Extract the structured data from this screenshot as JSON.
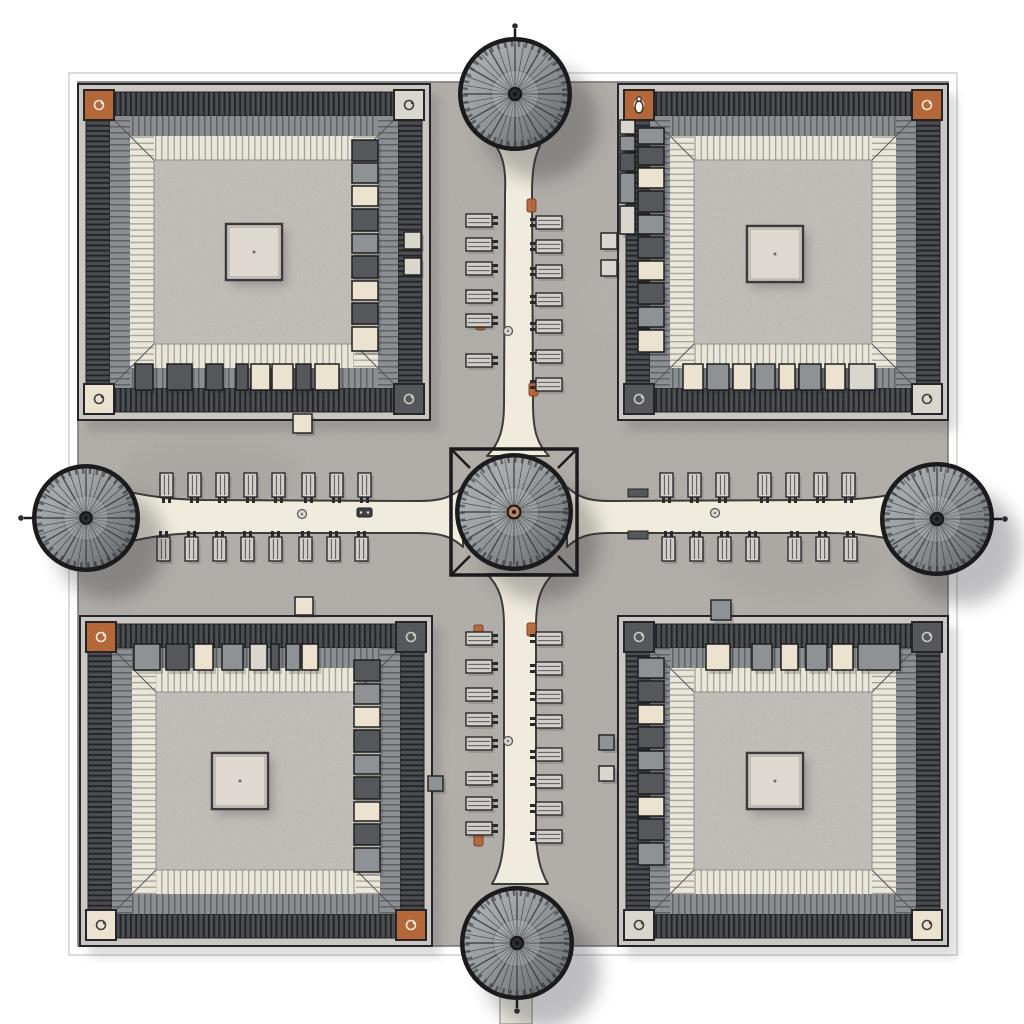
{
  "scene": {
    "type": "architectural-site-plan",
    "view": "top-down plan, hand-drawn ink and wash",
    "elements": "four courtyard buildings, five circular pavilion roofs, cross pathways with benches, market stalls, copper corner pavilions"
  },
  "colors": {
    "page_bg": "#ffffff",
    "ground": "#b5b2ad",
    "courtyard": "#c8c5bf",
    "wall_light": "#cac7c2",
    "outline": "#26262a",
    "path_cream": "#efebdd",
    "corner_copper": "#b4683a",
    "corner_cream": "#ede5cf",
    "corner_light": "#d6d3cb",
    "corner_dark": "#5a5c5f",
    "stall_dark": "#55575a",
    "stall_mid": "#8f9294",
    "stall_cream": "#ebe3cf",
    "stall_light": "#d9d6ce",
    "hub_copper": "#b9824f",
    "accent_orange": "#b5673a",
    "rim_dark": "#1b1b1d"
  },
  "ground": {
    "x": 78,
    "y": 82,
    "w": 870,
    "h": 864
  },
  "boundary": {
    "inner": [
      78,
      82,
      870,
      864
    ],
    "outer": [
      69,
      73,
      888,
      882
    ]
  },
  "buildings": [
    {
      "id": "northwest",
      "x": 78,
      "y": 84,
      "w": 352,
      "h": 336,
      "corners": {
        "tl": "copper",
        "tr": "light",
        "bl": "cream",
        "br": "dark"
      },
      "platform_dx": 0,
      "platform_dy": 0,
      "stall_rows": [
        {
          "dir": "h",
          "edge": "s",
          "boxes": [
            [
              135,
              18,
              "dark"
            ],
            [
              167,
              25,
              "dark"
            ],
            [
              206,
              17,
              "dark"
            ],
            [
              236,
              12,
              "dark"
            ],
            [
              251,
              19,
              "cream"
            ],
            [
              272,
              21,
              "cream"
            ],
            [
              296,
              15,
              "dark"
            ],
            [
              315,
              24,
              "cream"
            ]
          ]
        },
        {
          "dir": "v",
          "edge": "e",
          "boxes": [
            [
              140,
              21,
              "dark"
            ],
            [
              163,
              20,
              "mid"
            ],
            [
              186,
              20,
              "cream"
            ],
            [
              209,
              22,
              "dark"
            ],
            [
              234,
              19,
              "mid"
            ],
            [
              256,
              22,
              "dark"
            ],
            [
              281,
              19,
              "cream"
            ],
            [
              303,
              21,
              "dark"
            ],
            [
              327,
              24,
              "cream"
            ]
          ]
        }
      ],
      "kiosks": [
        [
          404,
          232,
          17,
          "light"
        ],
        [
          404,
          258,
          17,
          "light"
        ],
        [
          293,
          414,
          19,
          "cream"
        ]
      ]
    },
    {
      "id": "northeast",
      "x": 618,
      "y": 84,
      "w": 330,
      "h": 336,
      "corners": {
        "tl": "copper",
        "tr": "copper",
        "bl": "dark",
        "br": "light"
      },
      "corner_figure": "tl",
      "platform_dx": -8,
      "platform_dy": 2,
      "stall_rows": [
        {
          "dir": "v",
          "edge": "w",
          "boxes": [
            [
              128,
              16,
              "mid"
            ],
            [
              147,
              18,
              "dark"
            ],
            [
              168,
              20,
              "cream"
            ],
            [
              191,
              21,
              "dark"
            ],
            [
              215,
              19,
              "mid"
            ],
            [
              237,
              21,
              "dark"
            ],
            [
              261,
              19,
              "cream"
            ],
            [
              283,
              21,
              "dark"
            ],
            [
              307,
              20,
              "mid"
            ],
            [
              330,
              22,
              "cream"
            ]
          ]
        },
        {
          "dir": "v",
          "edge": "w",
          "x_override": 620,
          "w": 15,
          "boxes": [
            [
              120,
              14,
              "light"
            ],
            [
              136,
              15,
              "mid"
            ],
            [
              153,
              18,
              "dark"
            ],
            [
              173,
              30,
              "mid"
            ],
            [
              206,
              28,
              "light"
            ]
          ]
        },
        {
          "dir": "h",
          "edge": "s",
          "boxes": [
            [
              683,
              20,
              "cream"
            ],
            [
              707,
              22,
              "mid"
            ],
            [
              733,
              18,
              "cream"
            ],
            [
              755,
              20,
              "mid"
            ],
            [
              779,
              16,
              "cream"
            ],
            [
              799,
              22,
              "mid"
            ],
            [
              825,
              20,
              "cream"
            ],
            [
              849,
              26,
              "light"
            ]
          ]
        }
      ],
      "kiosks": [
        [
          601,
          233,
          16,
          "light"
        ],
        [
          601,
          260,
          16,
          "light"
        ]
      ]
    },
    {
      "id": "southwest",
      "x": 80,
      "y": 616,
      "w": 352,
      "h": 330,
      "corners": {
        "tl": "copper",
        "tr": "dark",
        "bl": "cream",
        "br": "copper"
      },
      "platform_dx": -16,
      "platform_dy": 0,
      "stall_rows": [
        {
          "dir": "h",
          "edge": "n",
          "boxes": [
            [
              134,
              26,
              "mid"
            ],
            [
              166,
              23,
              "dark"
            ],
            [
              194,
              19,
              "cream"
            ],
            [
              222,
              21,
              "mid"
            ],
            [
              250,
              17,
              "light"
            ],
            [
              271,
              8,
              "dark"
            ],
            [
              286,
              14,
              "mid"
            ],
            [
              302,
              16,
              "cream"
            ]
          ]
        },
        {
          "dir": "v",
          "edge": "e",
          "boxes": [
            [
              660,
              21,
              "dark"
            ],
            [
              684,
              20,
              "mid"
            ],
            [
              707,
              20,
              "cream"
            ],
            [
              730,
              22,
              "dark"
            ],
            [
              755,
              19,
              "mid"
            ],
            [
              777,
              22,
              "dark"
            ],
            [
              802,
              19,
              "cream"
            ],
            [
              824,
              21,
              "dark"
            ],
            [
              848,
              24,
              "mid"
            ]
          ]
        }
      ],
      "kiosks": [
        [
          295,
          597,
          18,
          "cream"
        ],
        [
          428,
          776,
          15,
          "mid"
        ]
      ]
    },
    {
      "id": "southeast",
      "x": 618,
      "y": 616,
      "w": 330,
      "h": 330,
      "corners": {
        "tl": "dark",
        "tr": "dark",
        "bl": "light",
        "br": "cream"
      },
      "platform_dx": -8,
      "platform_dy": 0,
      "stall_rows": [
        {
          "dir": "h",
          "edge": "n",
          "boxes": [
            [
              706,
              24,
              "cream"
            ],
            [
              752,
              20,
              "mid"
            ],
            [
              781,
              17,
              "cream"
            ],
            [
              806,
              21,
              "mid"
            ],
            [
              832,
              21,
              "cream"
            ],
            [
              858,
              42,
              "mid"
            ]
          ]
        },
        {
          "dir": "v",
          "edge": "w",
          "boxes": [
            [
              658,
              20,
              "mid"
            ],
            [
              681,
              21,
              "dark"
            ],
            [
              705,
              19,
              "cream"
            ],
            [
              727,
              21,
              "dark"
            ],
            [
              751,
              19,
              "mid"
            ],
            [
              773,
              21,
              "dark"
            ],
            [
              797,
              19,
              "cream"
            ],
            [
              819,
              21,
              "dark"
            ],
            [
              843,
              22,
              "mid"
            ]
          ]
        }
      ],
      "kiosks": [
        [
          711,
          600,
          20,
          "mid"
        ],
        [
          599,
          735,
          15,
          "mid"
        ],
        [
          599,
          766,
          15,
          "light"
        ]
      ]
    }
  ],
  "pavilions": [
    {
      "id": "north",
      "cx": 515,
      "cy": 94,
      "r": 56,
      "finial": "n"
    },
    {
      "id": "south",
      "cx": 517,
      "cy": 943,
      "r": 56,
      "finial": "s"
    },
    {
      "id": "west",
      "cx": 86,
      "cy": 518,
      "r": 53,
      "finial": "w"
    },
    {
      "id": "east",
      "cx": 937,
      "cy": 519,
      "r": 56,
      "finial": "e"
    },
    {
      "id": "center",
      "cx": 514,
      "cy": 512,
      "r": 58,
      "finial": "none",
      "frame": true,
      "hub": "copper"
    }
  ],
  "benches": {
    "h_arms": [
      {
        "name": "west-top",
        "y": 473,
        "legs": "down",
        "xs": [
          160,
          188,
          216,
          244,
          272,
          302,
          330,
          358
        ]
      },
      {
        "name": "west-bottom",
        "y": 537,
        "legs": "up",
        "xs": [
          157,
          185,
          213,
          241,
          269,
          299,
          327,
          355
        ]
      },
      {
        "name": "east-top",
        "y": 473,
        "legs": "down",
        "xs": [
          660,
          688,
          716,
          758,
          786,
          814,
          842
        ]
      },
      {
        "name": "east-bottom",
        "y": 537,
        "legs": "up",
        "xs": [
          662,
          690,
          718,
          746,
          788,
          816,
          844
        ]
      }
    ],
    "v_arms": [
      {
        "name": "north-left",
        "x": 466,
        "legs": "right",
        "ys": [
          214,
          238,
          262,
          290,
          314,
          354
        ]
      },
      {
        "name": "north-right",
        "x": 536,
        "legs": "left",
        "ys": [
          216,
          240,
          265,
          293,
          320,
          350,
          378
        ]
      },
      {
        "name": "south-left",
        "x": 466,
        "legs": "right",
        "ys": [
          632,
          660,
          688,
          713,
          737,
          772,
          797,
          822
        ]
      },
      {
        "name": "south-right",
        "x": 536,
        "legs": "left",
        "ys": [
          632,
          662,
          690,
          715,
          748,
          775,
          802,
          830
        ]
      }
    ]
  },
  "accents": {
    "planters": [
      [
        527,
        199
      ],
      [
        476,
        317
      ],
      [
        529,
        383
      ],
      [
        474,
        625
      ],
      [
        527,
        623
      ],
      [
        474,
        833
      ]
    ],
    "manholes": [
      [
        302,
        514
      ],
      [
        508,
        331
      ],
      [
        715,
        513
      ],
      [
        508,
        741
      ]
    ],
    "caps": [
      [
        628,
        489
      ],
      [
        628,
        531
      ]
    ],
    "cart": [
      357,
      508
    ]
  }
}
